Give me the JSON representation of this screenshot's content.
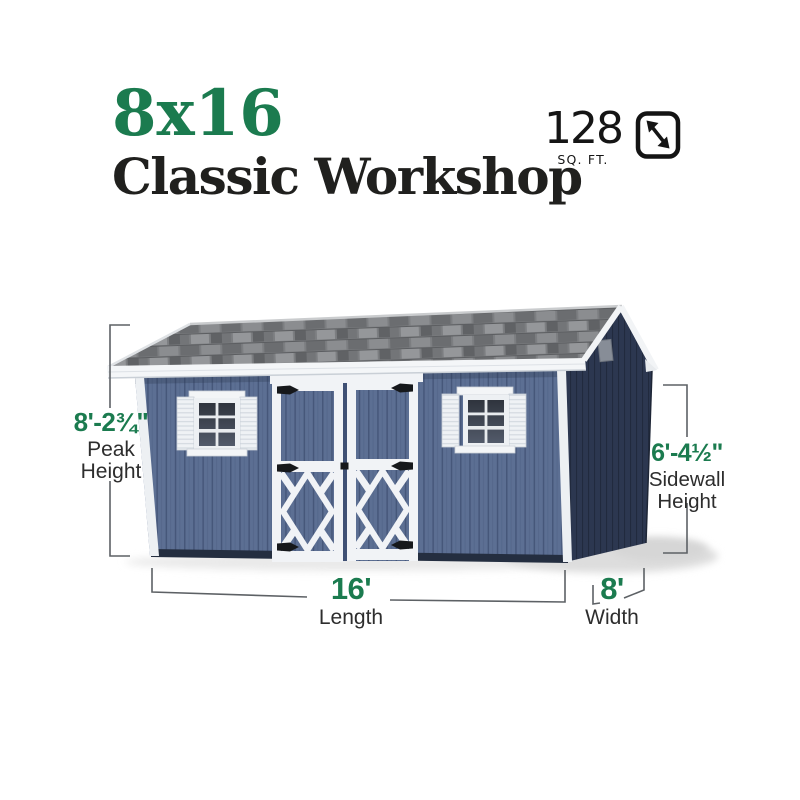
{
  "title": {
    "size_label": "8x16",
    "model_name": "Classic Workshop"
  },
  "area": {
    "value": "128",
    "unit": "SQ. FT."
  },
  "dimensions": {
    "peak_height": {
      "value": "8'-2¾\"",
      "label_lines": [
        "Peak",
        "Height"
      ]
    },
    "sidewall_height": {
      "value": "6'-4½\"",
      "label_lines": [
        "Sidewall",
        "Height"
      ]
    },
    "length": {
      "value": "16'",
      "label": "Length"
    },
    "width": {
      "value": "8'",
      "label": "Width"
    }
  },
  "icons": {
    "area_icon": "diagonal-expand-arrows-icon"
  },
  "colors": {
    "accent_green": "#1b7b4f",
    "text_dark": "#20201e",
    "siding_blue": "#5c6f93",
    "gable_navy": "#2c3750",
    "roof_gray": "#7c7e81",
    "trim_white": "#f2f4f6",
    "dimension_line_gray": "#5d6165"
  }
}
